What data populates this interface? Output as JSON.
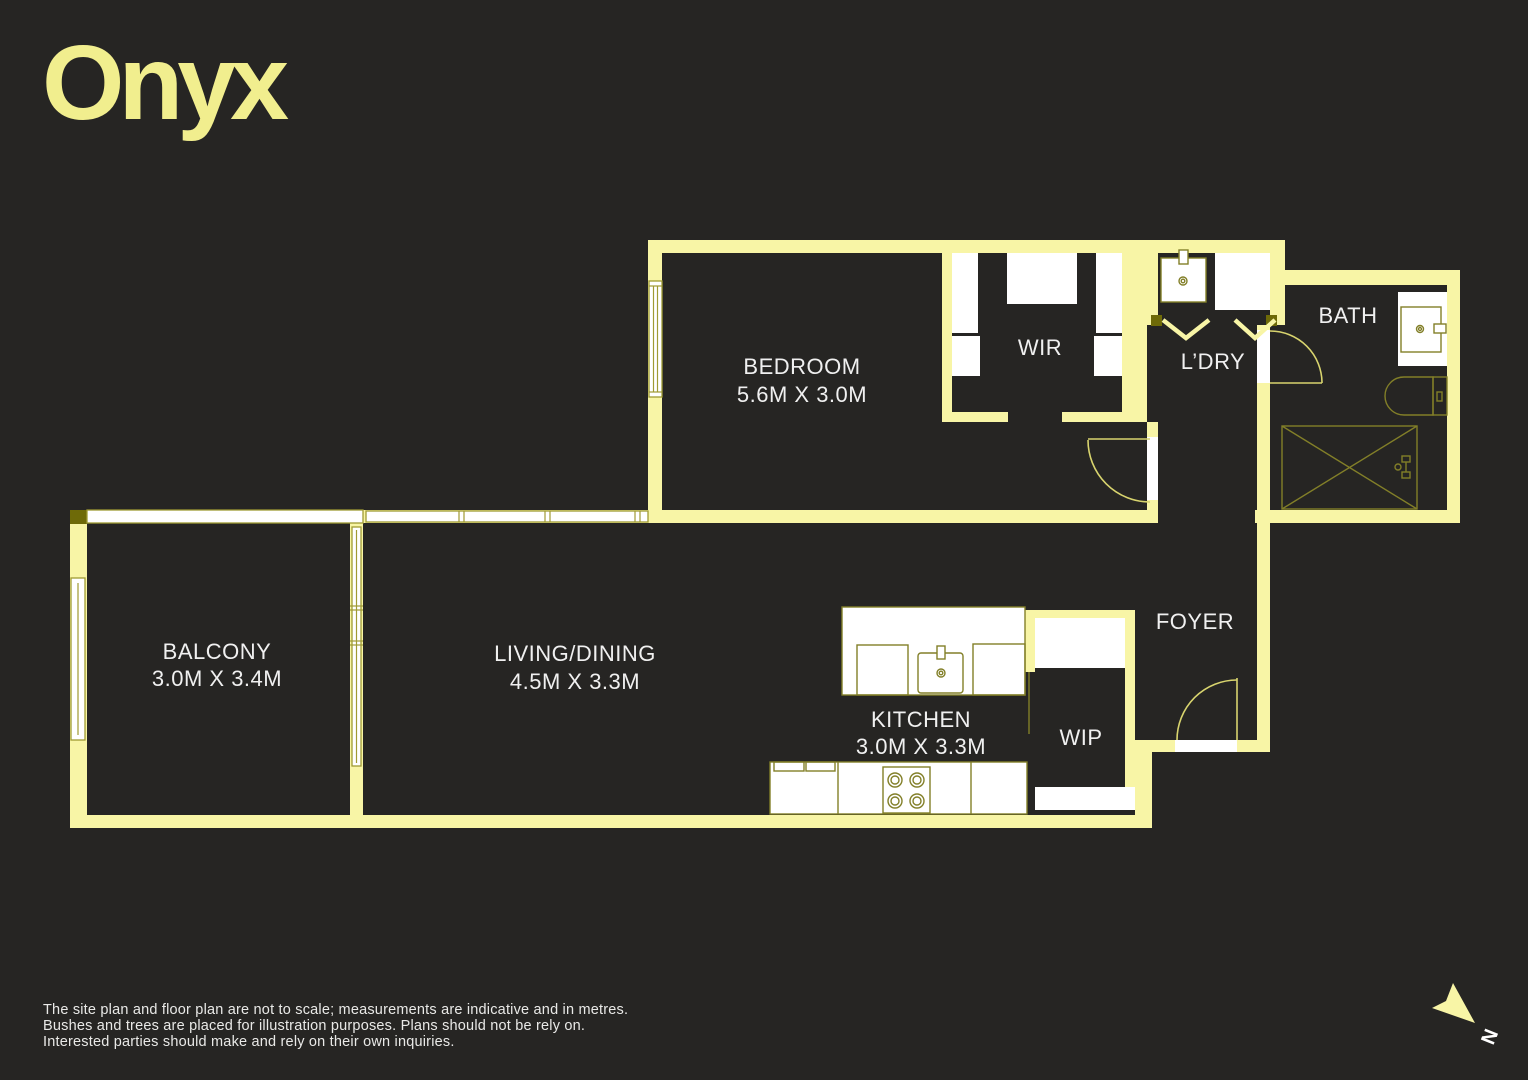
{
  "logo": "Onyx",
  "rooms": {
    "bedroom": {
      "name": "BEDROOM",
      "dims": "5.6M X 3.0M"
    },
    "wir": {
      "name": "WIR"
    },
    "ldry": {
      "name": "L’DRY"
    },
    "bath": {
      "name": "BATH"
    },
    "balcony": {
      "name": "BALCONY",
      "dims": "3.0M X 3.4M"
    },
    "living": {
      "name": "LIVING/DINING",
      "dims": "4.5M X 3.3M"
    },
    "kitchen": {
      "name": "KITCHEN",
      "dims": "3.0M X 3.3M"
    },
    "wip": {
      "name": "WIP"
    },
    "foyer": {
      "name": "FOYER"
    }
  },
  "compass": {
    "north_label": "N"
  },
  "disclaimer": {
    "line1": "The site plan and floor plan are not to scale; measurements are indicative and in metres.",
    "line2": "Bushes and trees are placed for illustration purposes. Plans should not be rely on.",
    "line3": "Interested parties should make and rely on their own inquiries."
  },
  "colors": {
    "bg": "#262523",
    "wall": "#f8f5a6",
    "winStroke": "#9f9a33",
    "fixture": "#827f28",
    "door": "#d8d46e",
    "olive": "#6e6a08",
    "label": "#f0f0f0",
    "logo": "#f1ee8e",
    "disclaimer": "#e9e9e7",
    "white": "#ffffff"
  }
}
